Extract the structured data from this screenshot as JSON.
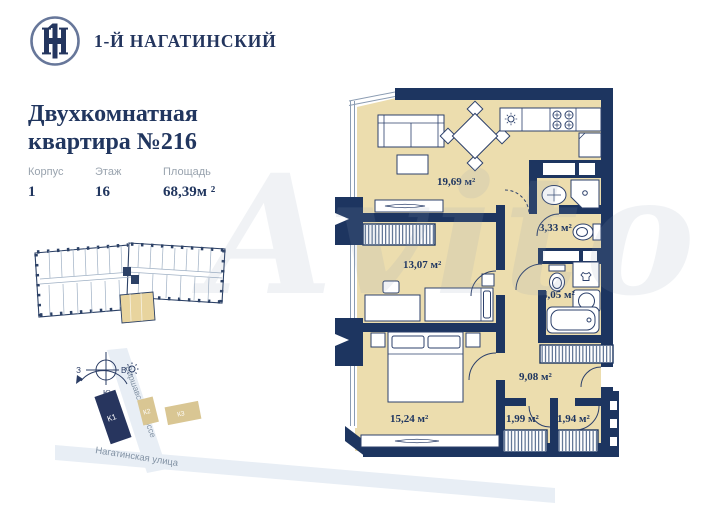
{
  "brand": {
    "logo_text": "1-Й НАГАТИНСКИЙ"
  },
  "header": {
    "title_line1": "Двухкомнатная",
    "title_line2": "квартира №216",
    "meta": [
      {
        "label": "Корпус",
        "value": "1"
      },
      {
        "label": "Этаж",
        "value": "16"
      },
      {
        "label": "Площадь",
        "value": "68,39м ²"
      }
    ]
  },
  "floor_plan": {
    "rooms": [
      {
        "name": "kitchen-living-room",
        "area": "19,69 м²"
      },
      {
        "name": "hallway",
        "area": "3,33 м²"
      },
      {
        "name": "bedroom",
        "area": "13,07 м²"
      },
      {
        "name": "bathroom",
        "area": "4,05 м²"
      },
      {
        "name": "corridor",
        "area": "9,08 м²"
      },
      {
        "name": "master-bedroom",
        "area": "15,24 м²"
      },
      {
        "name": "wardrobe-left",
        "area": "1,99 м²"
      },
      {
        "name": "wardrobe-right",
        "area": "1,94 м²"
      }
    ]
  },
  "site_map": {
    "streets": [
      {
        "name": "Варшавское шоссе"
      },
      {
        "name": "Нагатинская улица"
      }
    ],
    "buildings": [
      {
        "label": "К1"
      },
      {
        "label": "К2"
      },
      {
        "label": "К3"
      }
    ],
    "compass": {
      "west": "З",
      "east": "В",
      "south": "Ю"
    }
  },
  "watermark": "Avito",
  "colors": {
    "wall_navy": "#1d3560",
    "floor_tan": "#ecddae",
    "accent_gold": "#d9c693",
    "street": "#e8eef5",
    "text_navy": "#21365f",
    "text_gray": "#99a3ae"
  }
}
